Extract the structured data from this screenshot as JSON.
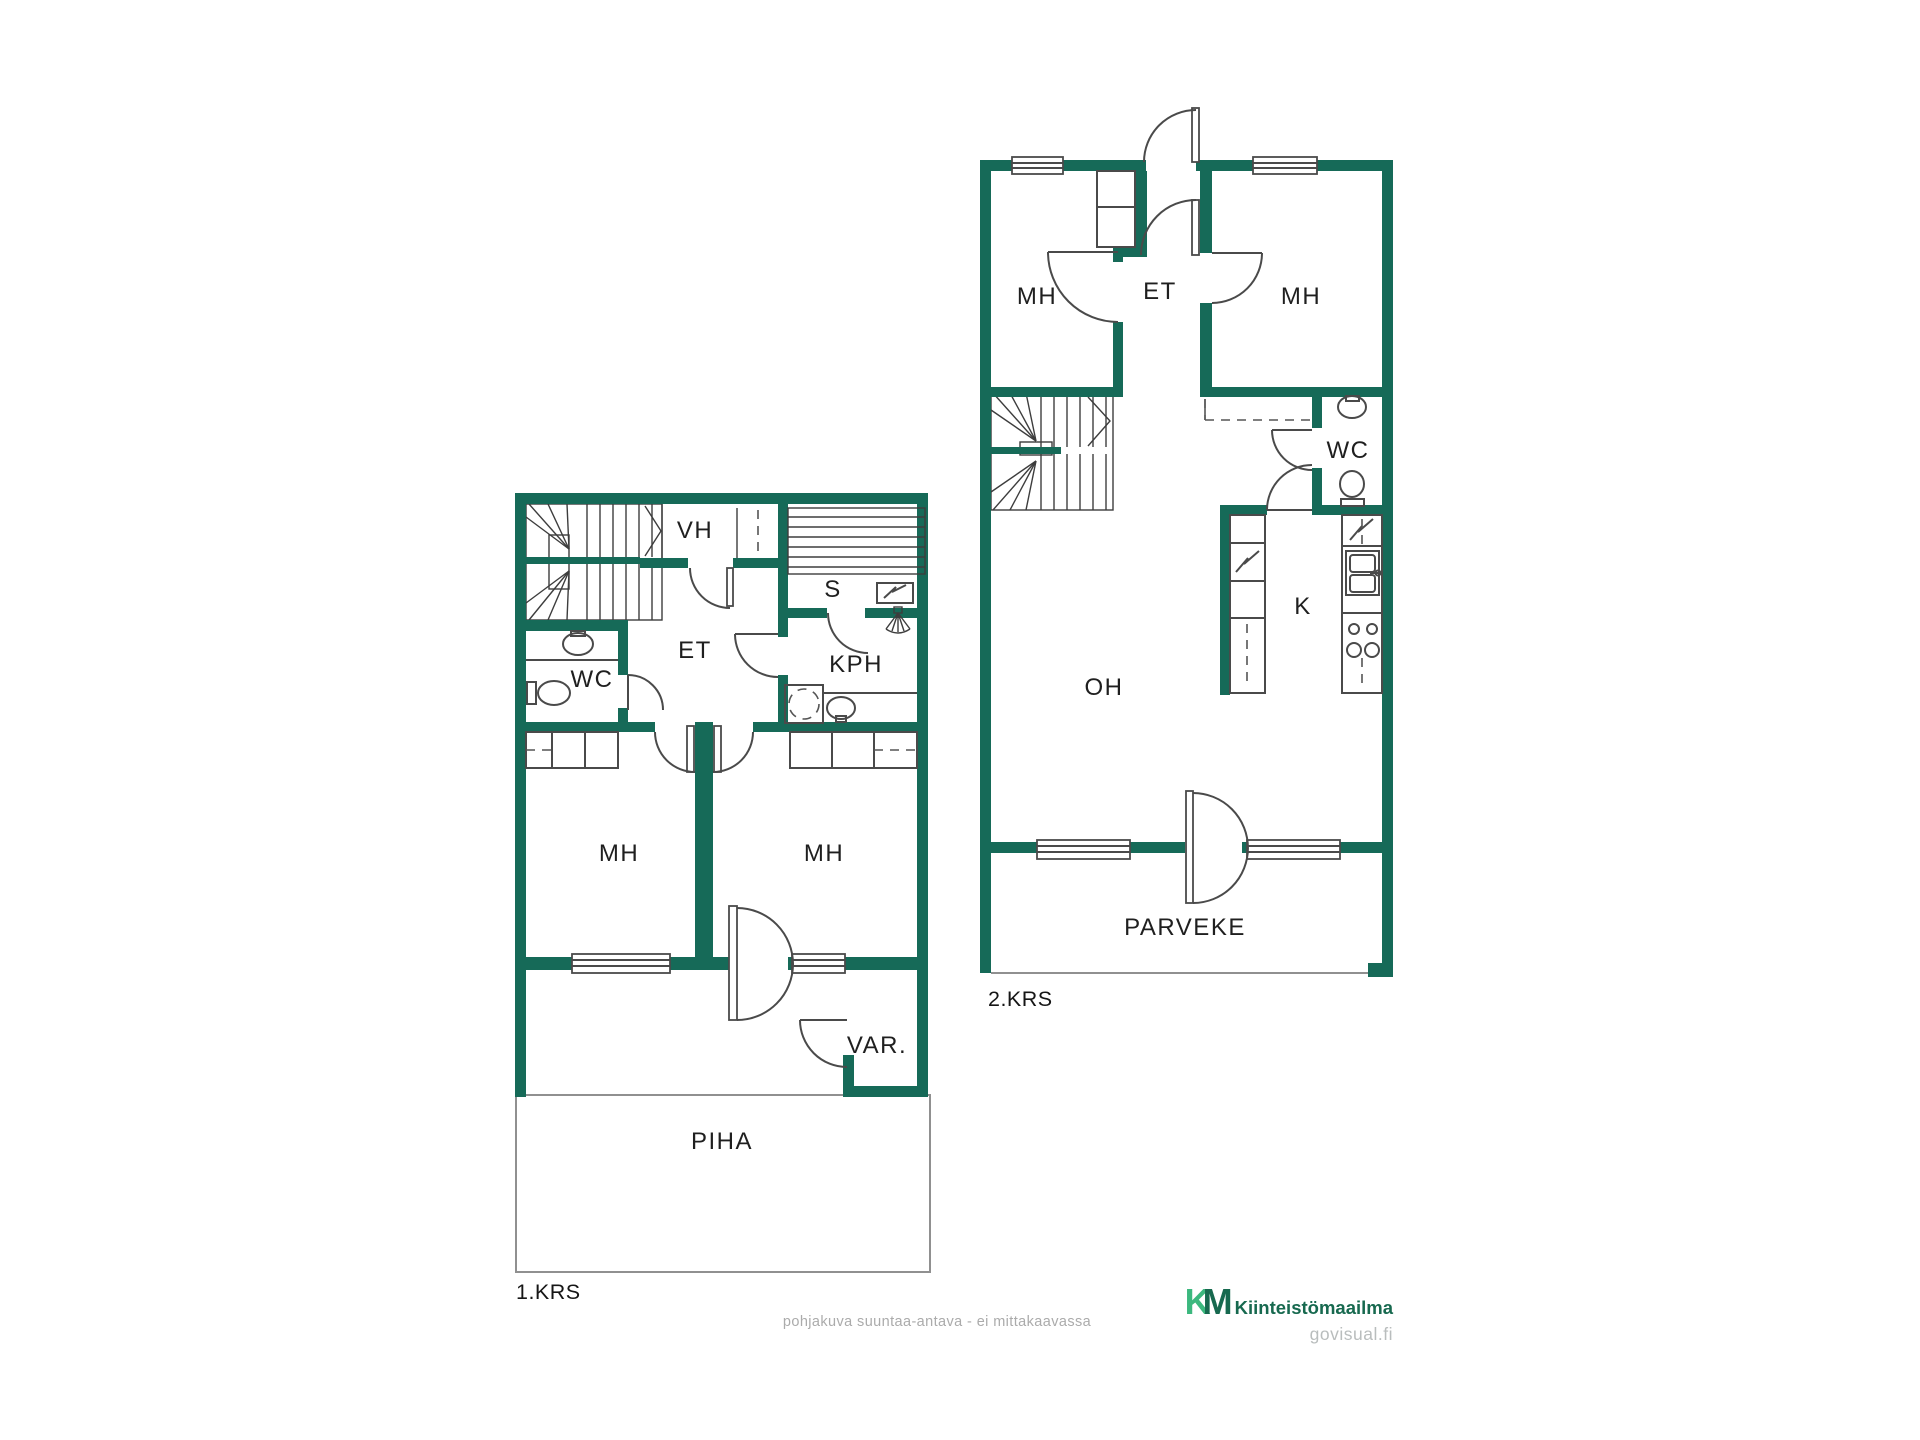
{
  "colors": {
    "wall_green": "#166A58",
    "thin_line": "#4A4A4A",
    "muted_line": "#909090",
    "label_text": "#1F1F1F",
    "footer_text": "#ABABAB",
    "brand_light_green": "#3CB87E",
    "brand_dark_green": "#17694F",
    "watermark_gray": "#B9BDBD"
  },
  "floor1": {
    "label": "1.KRS",
    "rooms": {
      "vh": "VH",
      "s": "S",
      "et": "ET",
      "wc": "WC",
      "kph": "KPH",
      "mh_left": "MH",
      "mh_right": "MH",
      "var": "VAR.",
      "piha": "PIHA"
    }
  },
  "floor2": {
    "label": "2.KRS",
    "rooms": {
      "mh_left": "MH",
      "et": "ET",
      "mh_right": "MH",
      "wc": "WC",
      "k": "K",
      "oh": "OH",
      "parveke": "PARVEKE"
    }
  },
  "footer": {
    "disclaimer": "pohjakuva suuntaa-antava - ei mittakaavassa"
  },
  "branding": {
    "logo_k": "K",
    "logo_m": "M",
    "logo_name": "Kiinteistömaailma",
    "watermark": "govisual.fi"
  }
}
